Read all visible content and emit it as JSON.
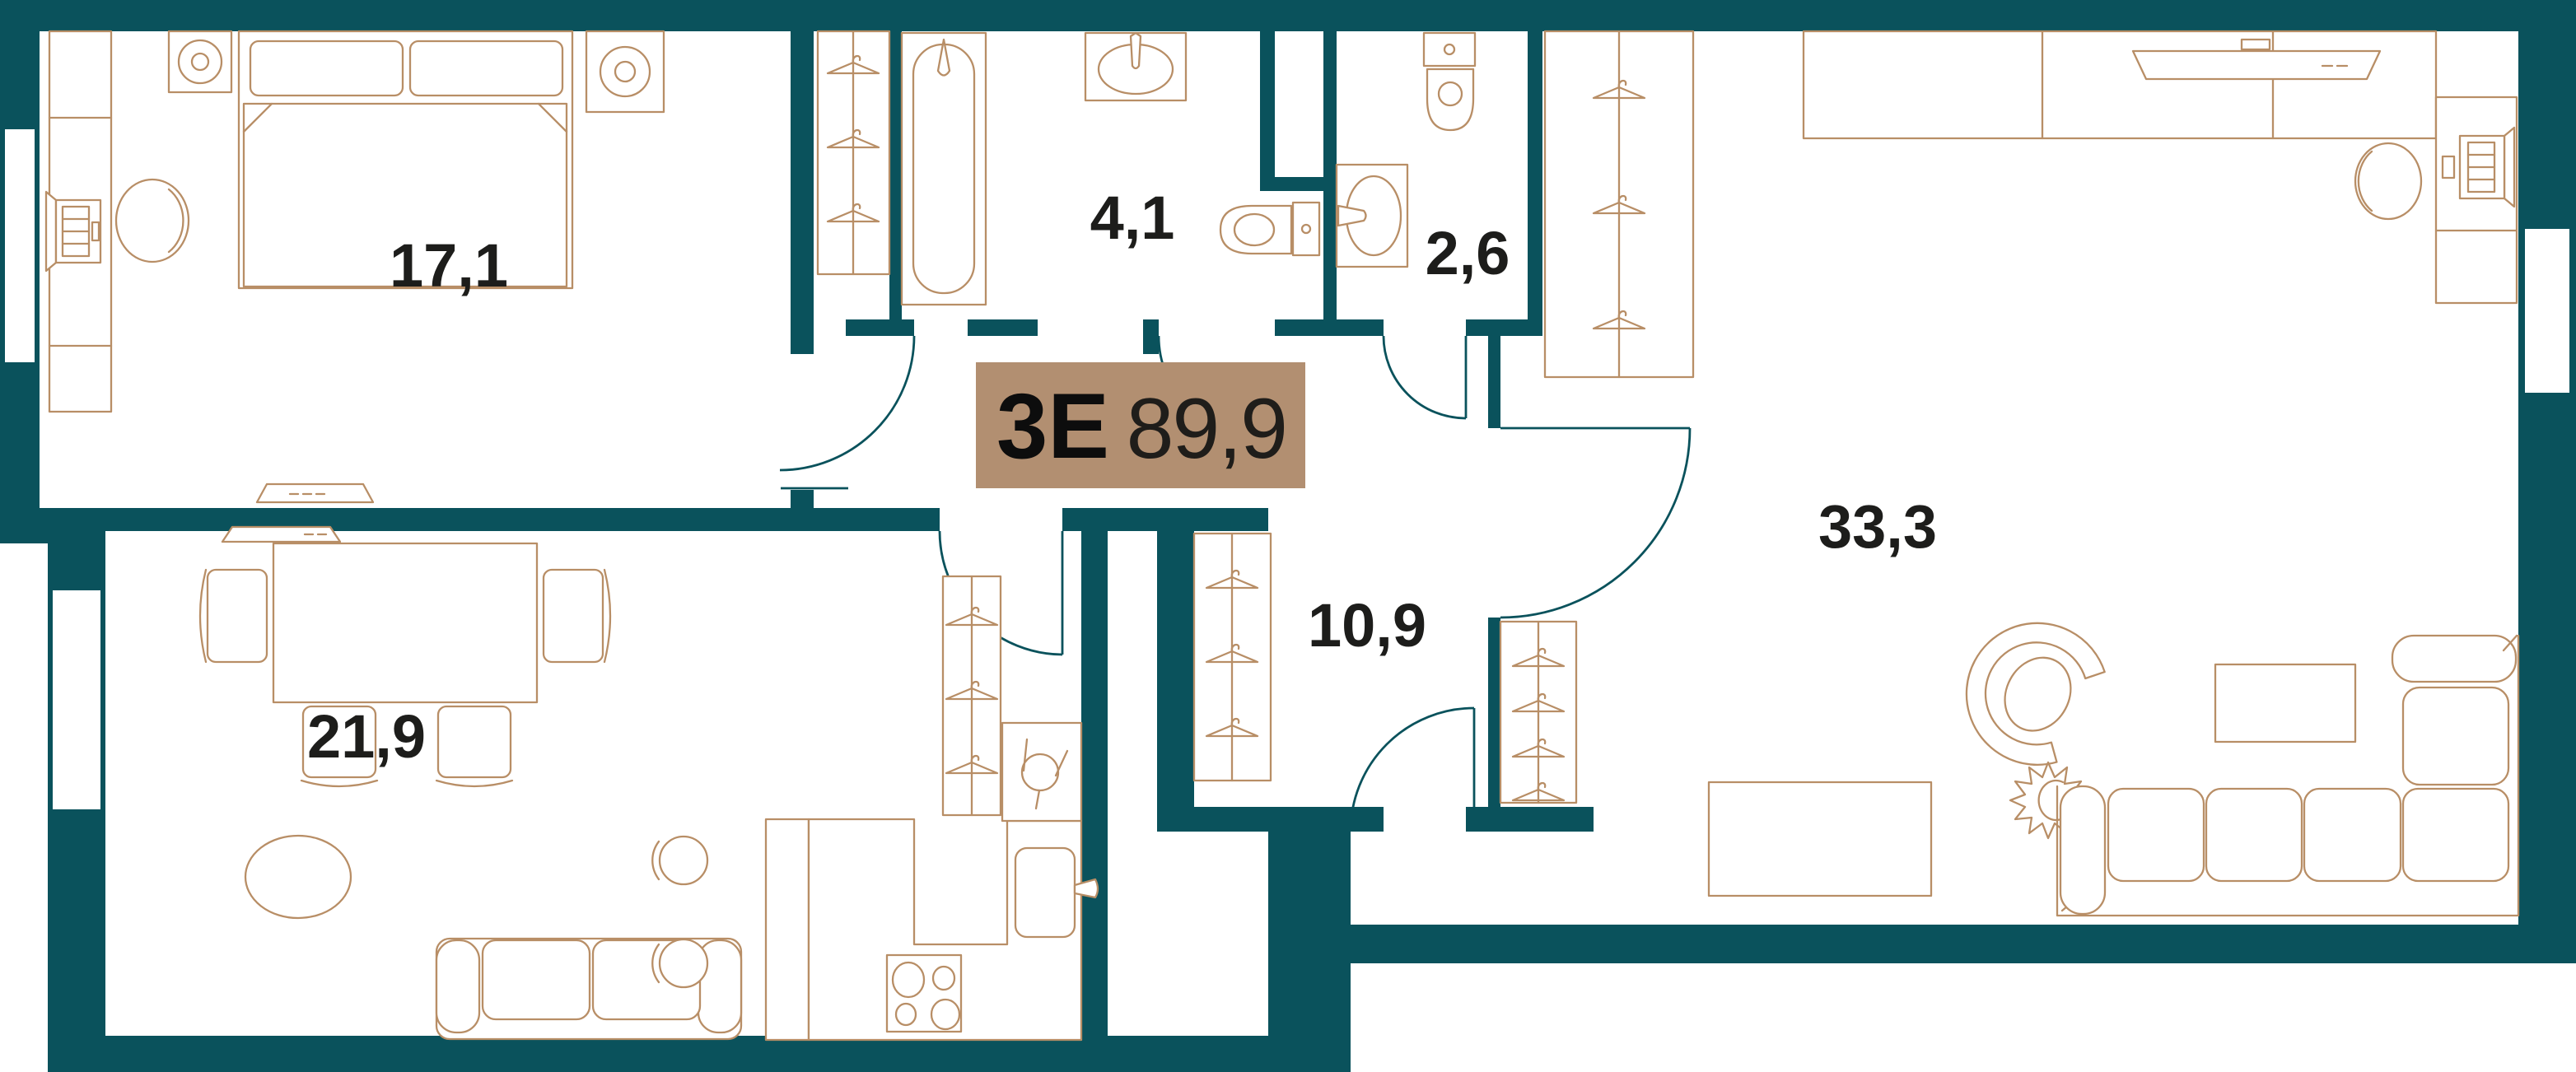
{
  "page": {
    "title": "Apartment floor plan"
  },
  "unit": {
    "type": "3Е",
    "area": "89,9"
  },
  "rooms": [
    {
      "name": "bedroom",
      "area": "17,1"
    },
    {
      "name": "bathroom",
      "area": "4,1"
    },
    {
      "name": "wc",
      "area": "2,6"
    },
    {
      "name": "hallway",
      "area": "10,9"
    },
    {
      "name": "kitchen-living",
      "area": "21,9"
    },
    {
      "name": "living",
      "area": "33,3"
    }
  ],
  "colors": {
    "wall": "#0a525c",
    "door": "#0a525c",
    "furniture": "#b88e66",
    "label": "#1d1d1b",
    "tag_bg": "#b28f71",
    "tag_text": "#0d0d0d",
    "background": "#ffffff"
  }
}
